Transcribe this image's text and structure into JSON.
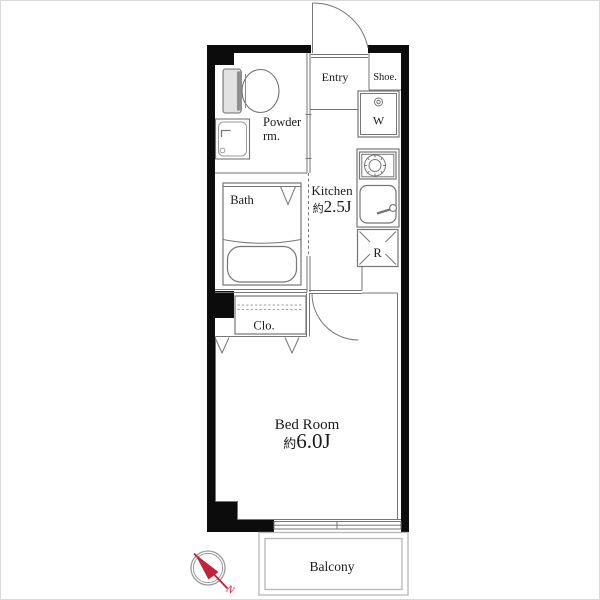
{
  "floorplan": {
    "wall_color": "#0c0c0c",
    "line_color": "#767676",
    "accent_color": "#c3203c",
    "rooms": {
      "entry": {
        "label": "Entry"
      },
      "shoe": {
        "label": "Shoe."
      },
      "powder_room": {
        "label_line1": "Powder",
        "label_line2": "rm."
      },
      "bath": {
        "label": "Bath"
      },
      "kitchen": {
        "label": "Kitchen",
        "area_prefix": "約",
        "area_value": "2.5J"
      },
      "closet": {
        "label": "Clo."
      },
      "bedroom": {
        "label": "Bed Room",
        "area_prefix": "約",
        "area_value": "6.0J"
      },
      "balcony": {
        "label": "Balcony"
      }
    },
    "fixtures": {
      "washing_machine": {
        "label": "W"
      },
      "refrigerator": {
        "label": "R"
      }
    },
    "compass": {
      "north_label": "N"
    }
  }
}
